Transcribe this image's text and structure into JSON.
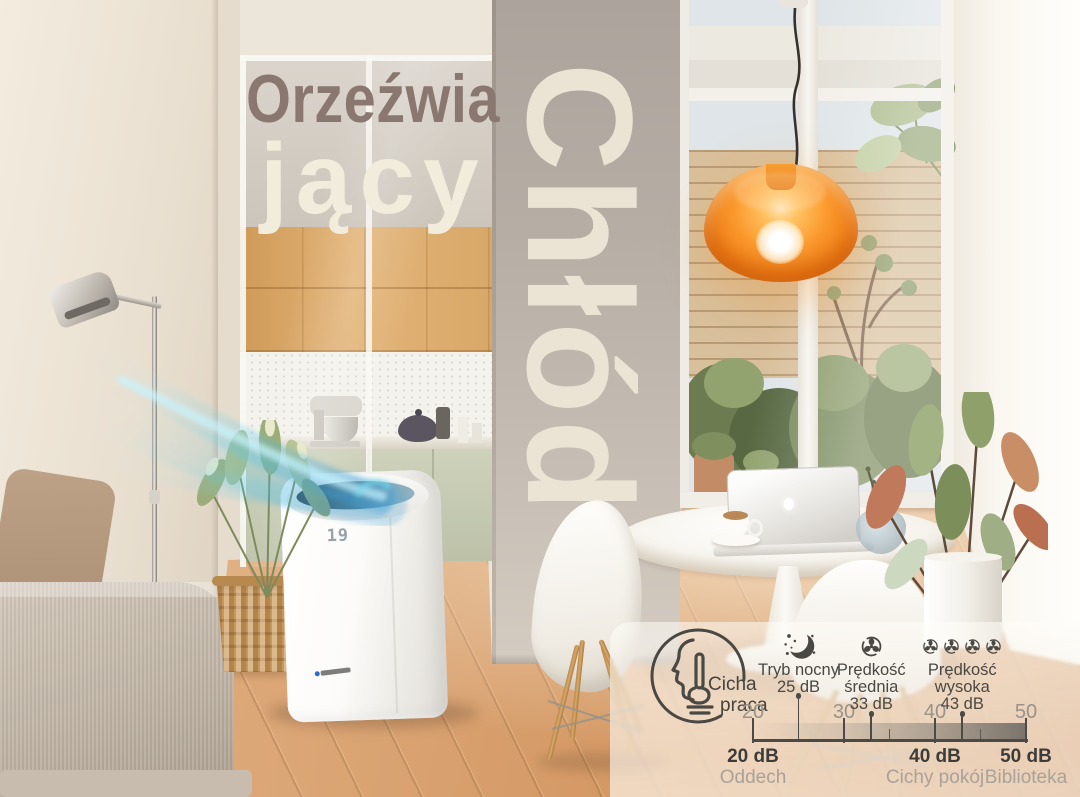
{
  "scene": {
    "headline_word1": "Orzeźwia",
    "headline_word2": "jący",
    "headline_vertical": "Chłód",
    "ac_display_value": "19"
  },
  "infographic": {
    "quiet_feature": {
      "icon": "shh-icon",
      "label_line1": "Cicha",
      "label_line2": "praca"
    },
    "modes": [
      {
        "name_lines": [
          "Tryb nocny"
        ],
        "db": 25,
        "db_label": "25 dB",
        "icon": "moon-icon",
        "icon_count": 1
      },
      {
        "name_lines": [
          "Prędkość",
          "średnia"
        ],
        "db": 33,
        "db_label": "33 dB",
        "icon": "fan-icon",
        "icon_count": 1
      },
      {
        "name_lines": [
          "Prędkość",
          "wysoka"
        ],
        "db": 43,
        "db_label": "43 dB",
        "icon": "fan-icon",
        "icon_count": 4
      }
    ],
    "scale": {
      "min": 20,
      "max": 50,
      "major_ticks": [
        20,
        30,
        40,
        50
      ],
      "minor_ticks": [
        25,
        35,
        45
      ]
    },
    "references": [
      {
        "value": 20,
        "db_label": "20 dB",
        "desc": "Oddech"
      },
      {
        "value": 40,
        "db_label": "40 dB",
        "desc": "Cichy pokój"
      },
      {
        "value": 50,
        "db_label": "50 dB",
        "desc": "Biblioteka"
      }
    ]
  },
  "colors": {
    "lamp_orange": "#f08119",
    "airflow_blue": "#3eb5e6",
    "headline_dark": "#8a7870",
    "headline_cream": "#f2ecdc",
    "infographic_text": "#4a4843",
    "infographic_muted": "#98928a"
  }
}
